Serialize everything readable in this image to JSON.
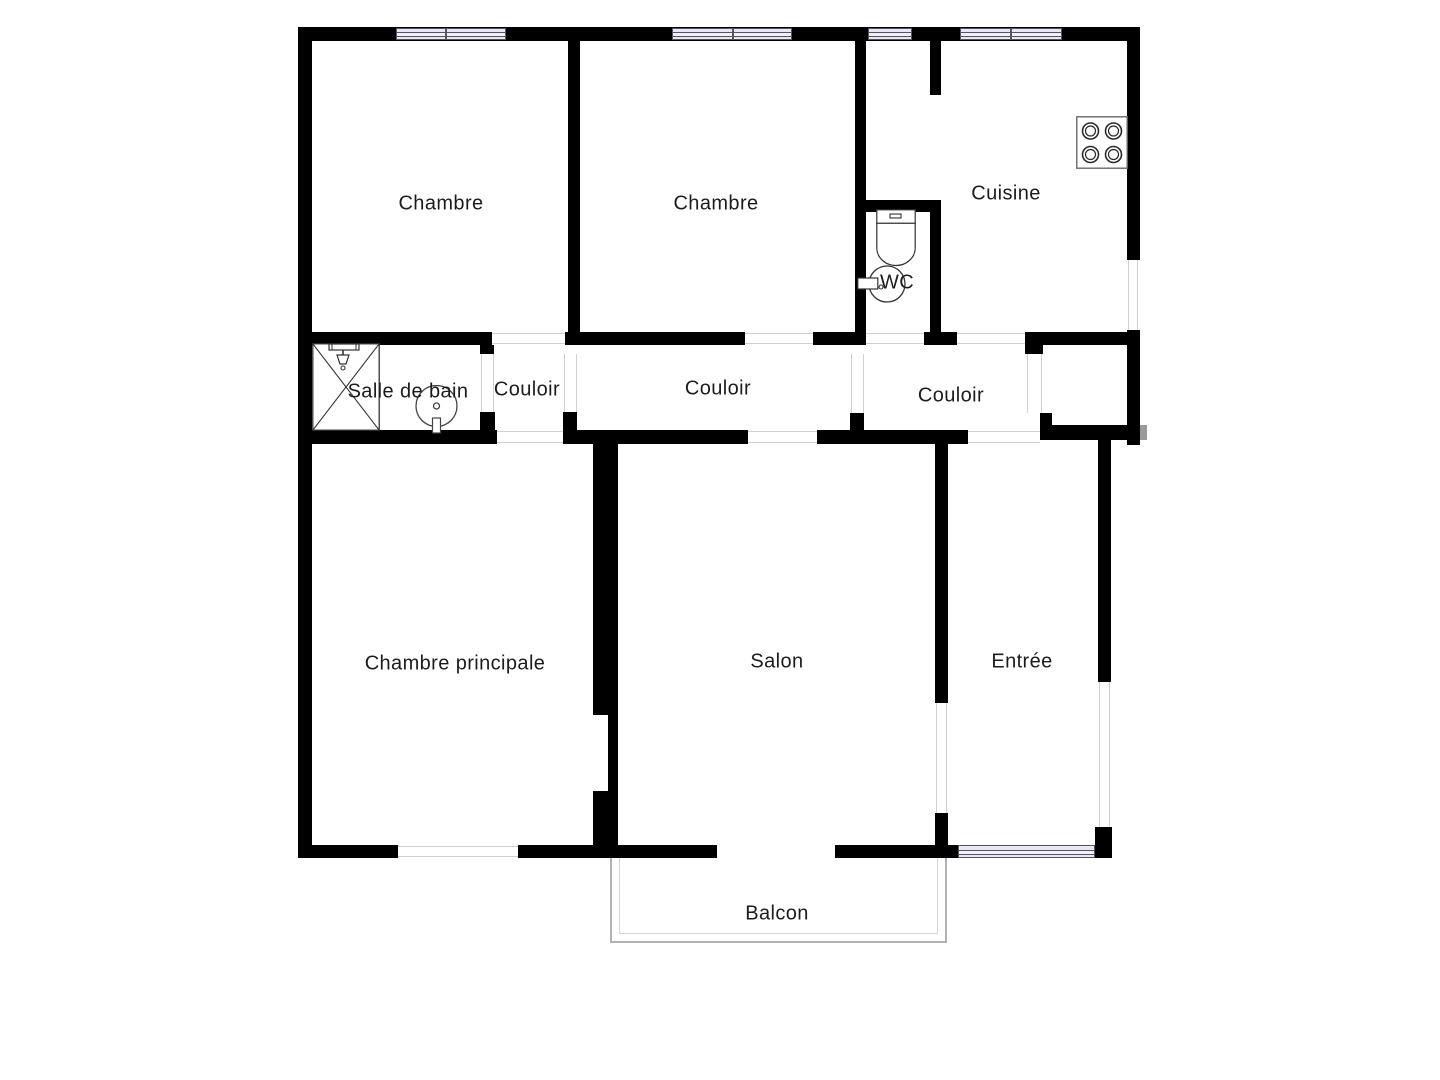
{
  "title": "Plan d'appartement",
  "rooms": {
    "chambre1": "Chambre",
    "chambre2": "Chambre",
    "cuisine": "Cuisine",
    "wc": "WC",
    "salle_de_bain": "Salle de bain",
    "couloir1": "Couloir",
    "couloir2": "Couloir",
    "couloir3": "Couloir",
    "chambre_principale": "Chambre principale",
    "salon": "Salon",
    "entree": "Entrée",
    "balcon": "Balcon"
  },
  "icons": {
    "stove": "stove-4-burners-icon",
    "toilet": "toilet-icon",
    "wc_washbasin": "round-washbasin-icon",
    "shower": "shower-cabin-icon",
    "bath_washbasin": "round-washbasin-icon"
  },
  "colors": {
    "wall": "#000000",
    "window_fill": "#e6e8f5",
    "window_frame": "#55555f",
    "door_opening_line": "#cfcfcf",
    "balcony_line_outer": "#b2b2b2",
    "balcony_line_inner": "#d5d5d5",
    "text": "#1c1c1c",
    "background": "#ffffff"
  }
}
